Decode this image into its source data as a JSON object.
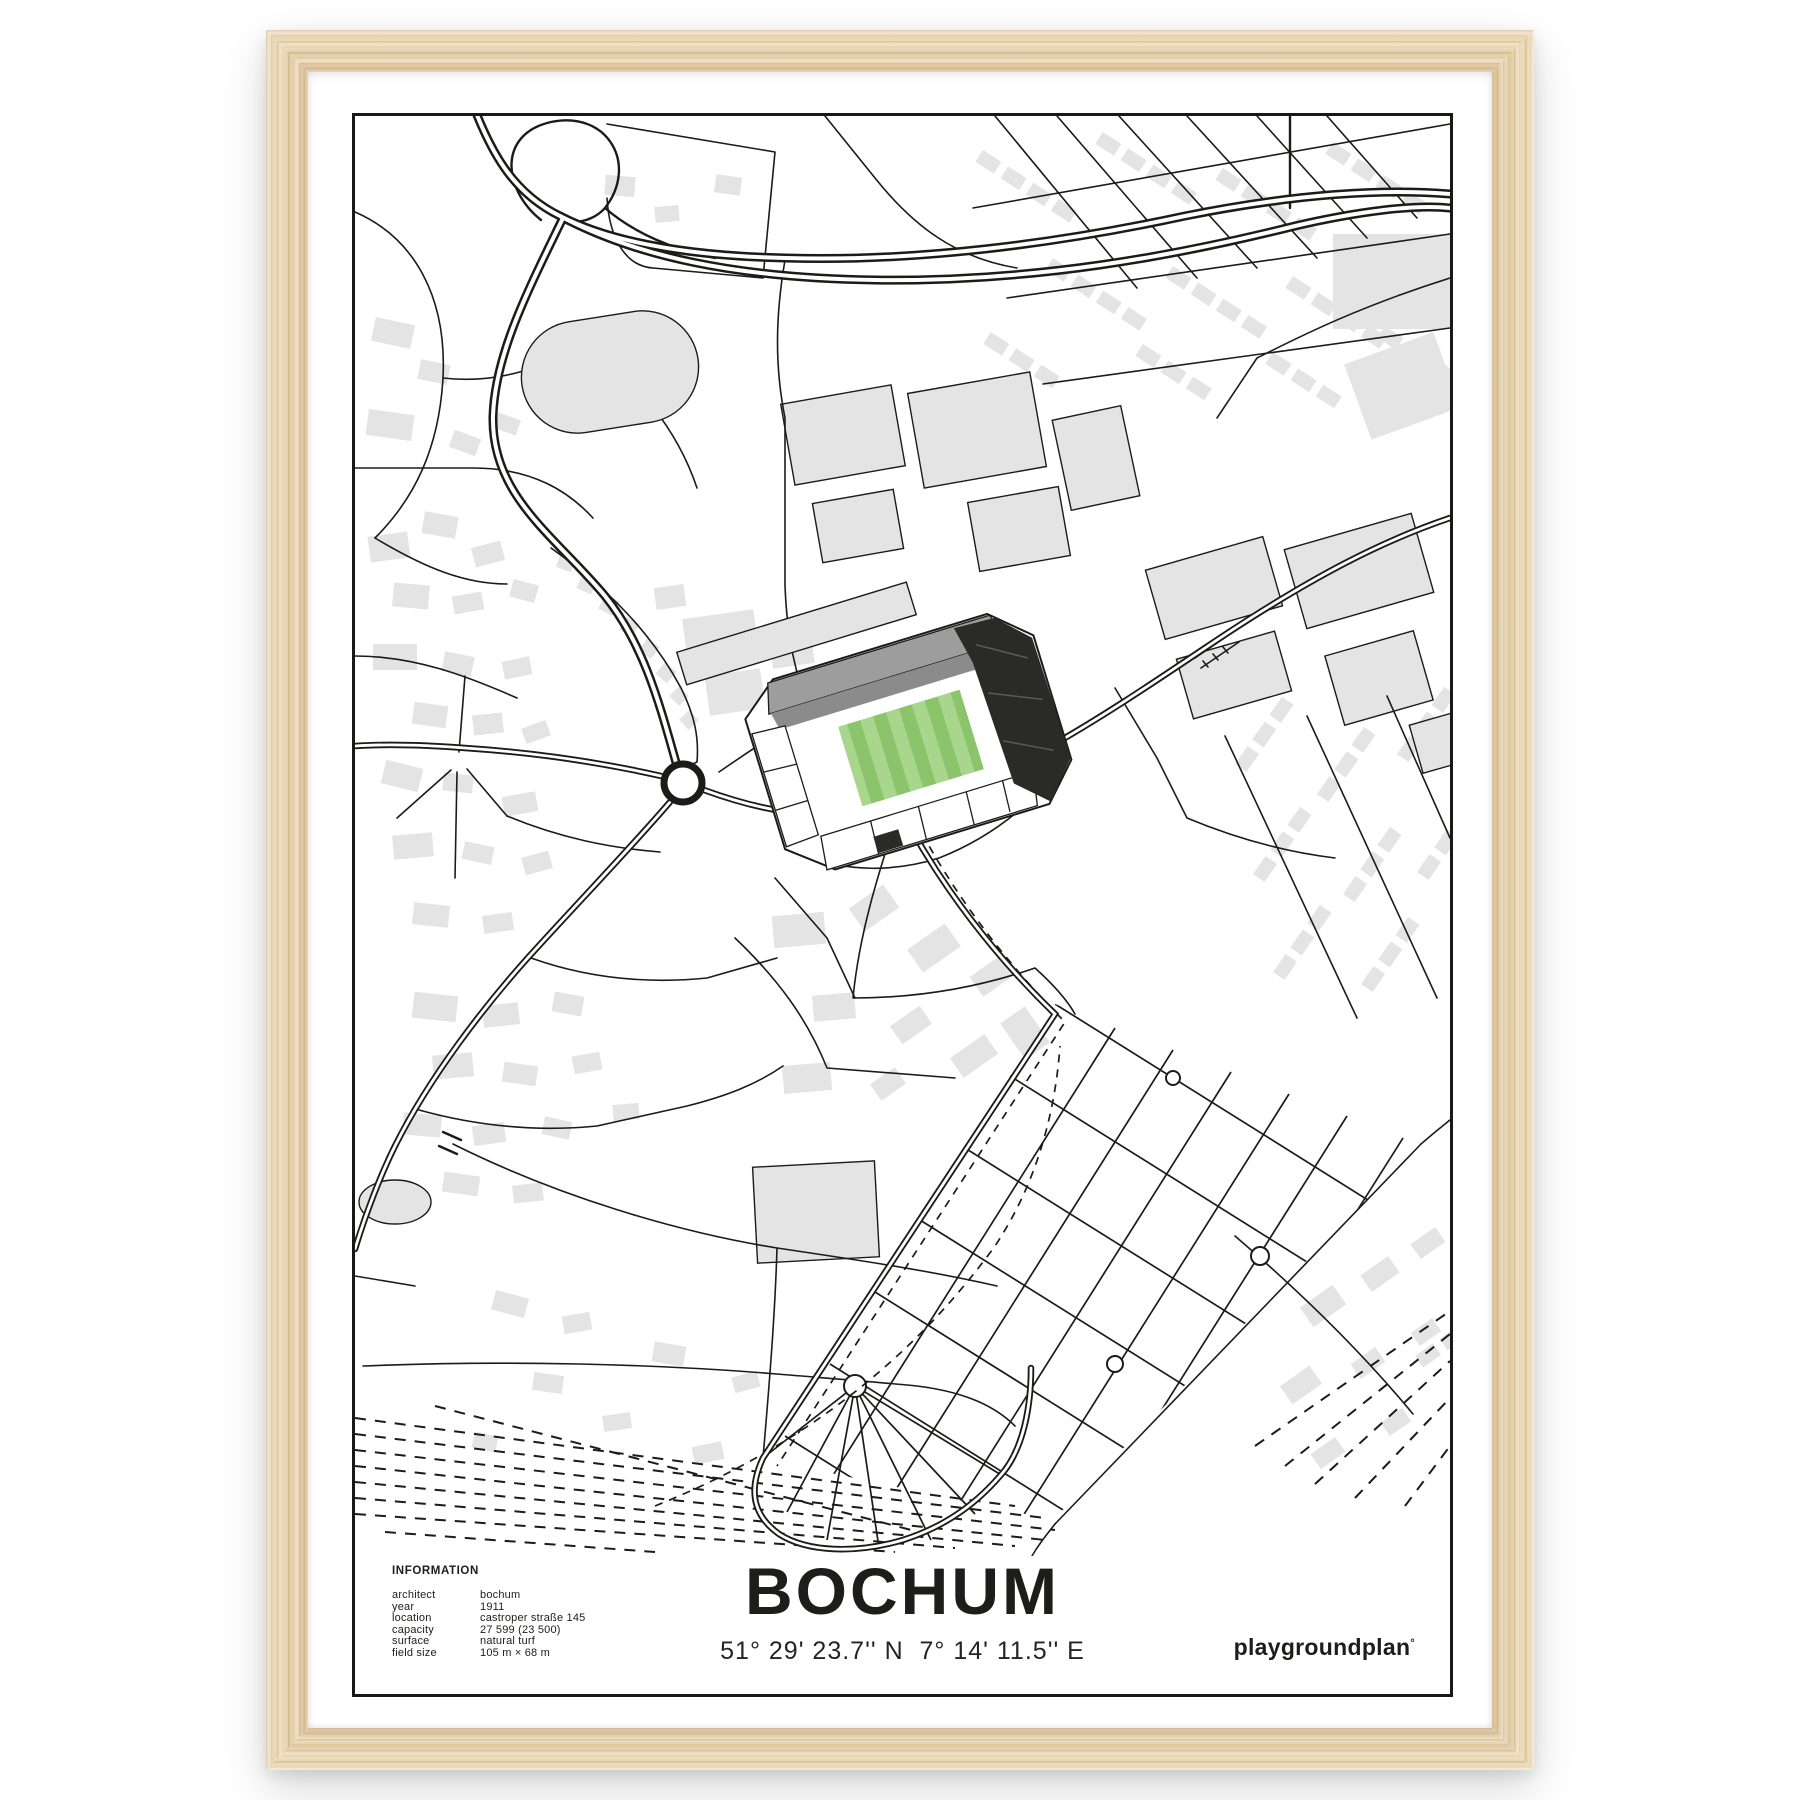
{
  "poster": {
    "title": "BOCHUM",
    "coordinates": "51° 29' 23.7'' N  7° 14' 11.5'' E",
    "brand": "playgroundplan",
    "brand_mark": "°",
    "information": {
      "heading": "INFORMATION",
      "rows": [
        {
          "label": "architect",
          "value": "bochum"
        },
        {
          "label": "year",
          "value": "1911"
        },
        {
          "label": "location",
          "value": "castroper straße 145"
        },
        {
          "label": "capacity",
          "value": "27 599 (23 500)"
        },
        {
          "label": "surface",
          "value": "natural turf"
        },
        {
          "label": "field size",
          "value": "105 m × 68 m"
        }
      ]
    }
  },
  "colors": {
    "pitch_dark": "#8bc46a",
    "pitch_light": "#a7d68c",
    "building": "#e4e4e5",
    "road": "#1b1b19",
    "stand_dark": "#2a2a28",
    "roof_gray": "#9d9d9d"
  }
}
